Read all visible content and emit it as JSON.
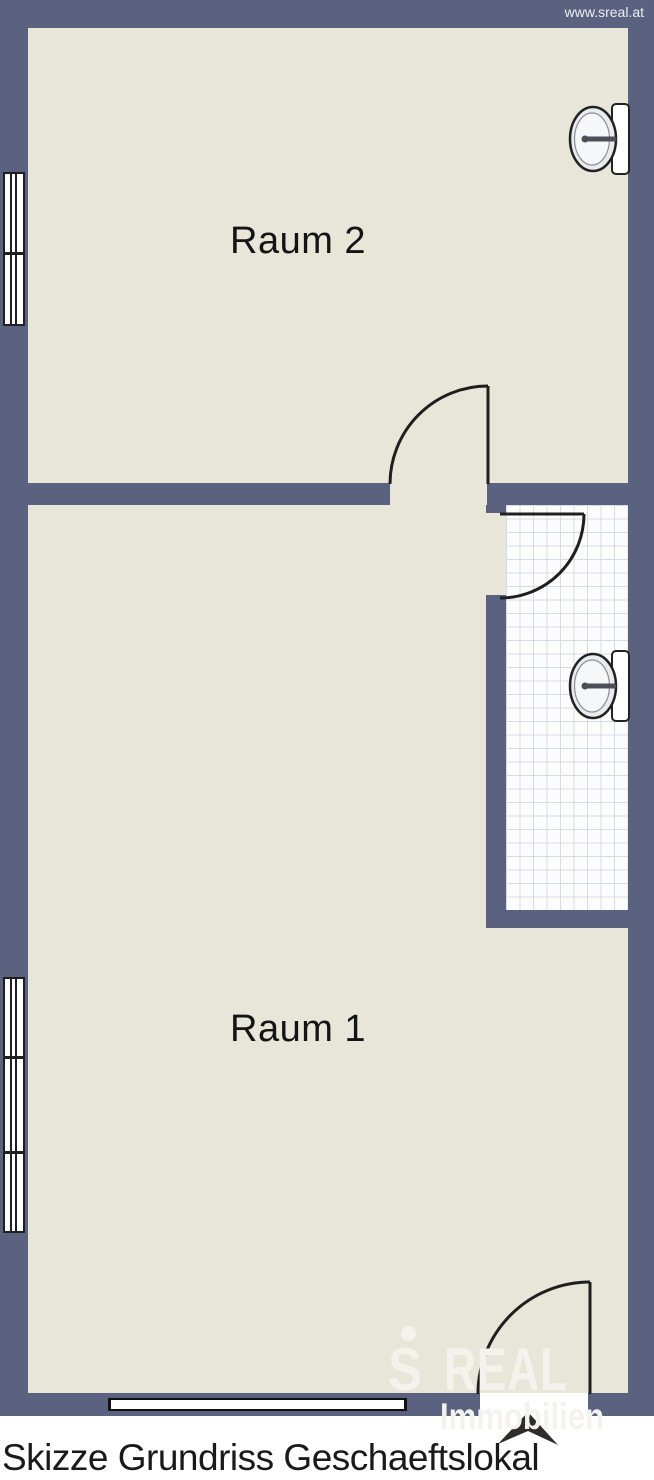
{
  "watermark": "www.sreal.at",
  "caption": "Skizze Grundriss Geschaeftslokal",
  "rooms": [
    {
      "label": "Raum 2"
    },
    {
      "label": "Raum 1"
    },
    {
      "label": "",
      "note": "tiled sanitary room (no text label)"
    }
  ],
  "logo": {
    "symbol": "S",
    "brand": "REAL",
    "subtitle": "Immobilien"
  },
  "icons": {
    "sink": "wash-basin",
    "north_arrow": "north-compass-arrow",
    "door": "door-swing-arc",
    "window": "double-glazed-window"
  },
  "colors": {
    "wall": "#5a6280",
    "floor": "#e8e5d9",
    "tile": "#fcfcfd",
    "tile_grid": "#d7dbe4",
    "line": "#1f1f1f",
    "logo": "#f3f2ed"
  }
}
